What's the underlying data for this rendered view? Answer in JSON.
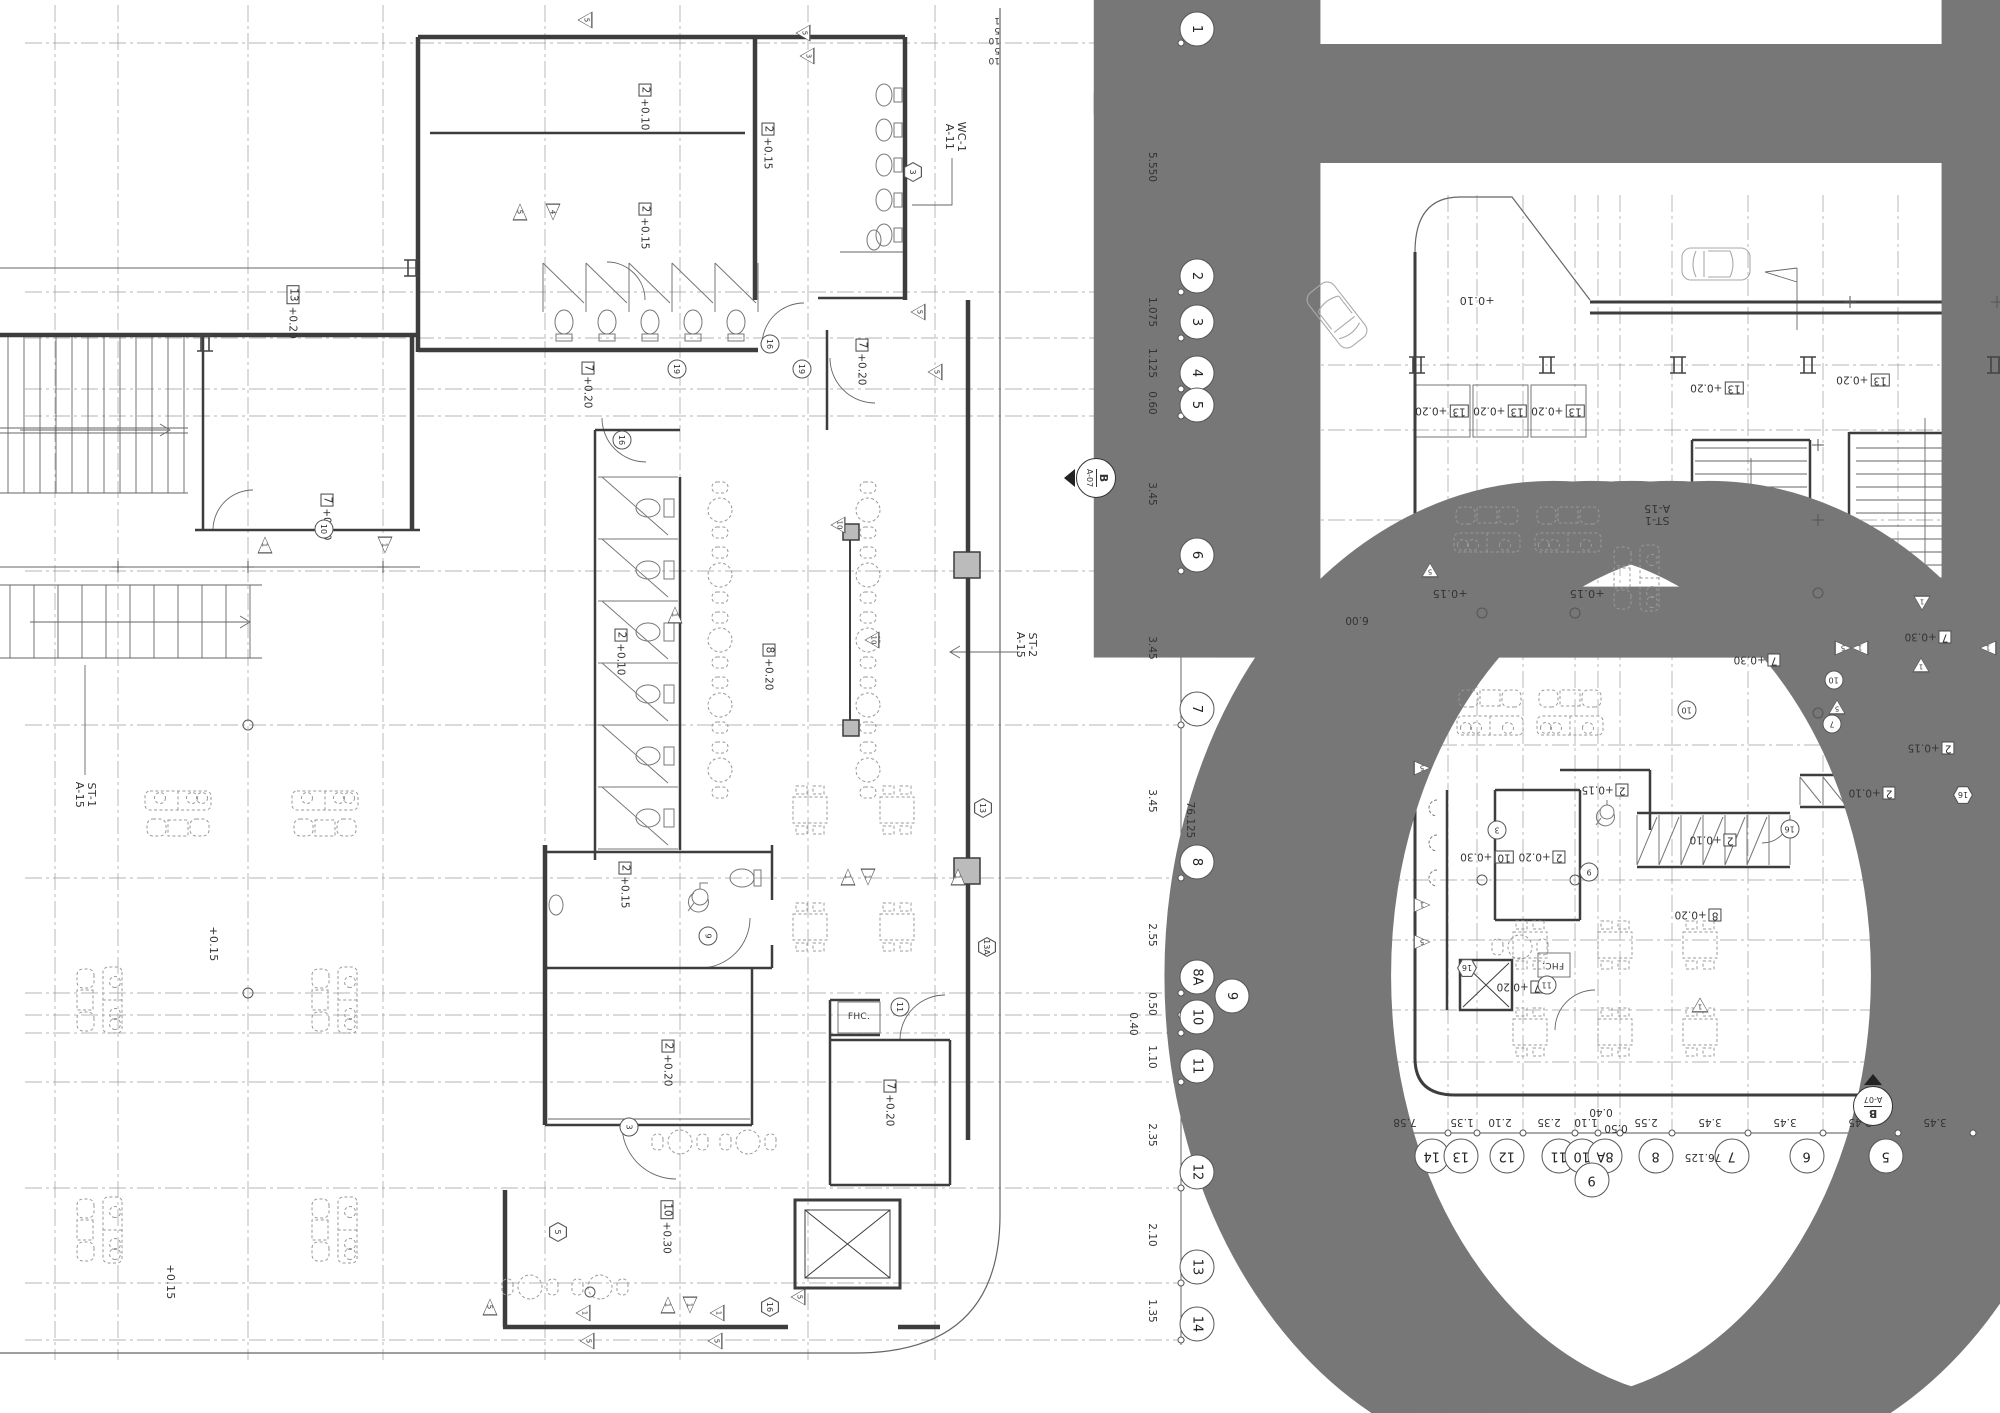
{
  "drawing": {
    "left_axis": {
      "bubbles": [
        "1",
        "2",
        "3",
        "4",
        "5",
        "6",
        "7",
        "8",
        "8A",
        "10",
        "9",
        "11",
        "12",
        "13",
        "14"
      ],
      "dims": [
        "5.550",
        "1.075",
        "1.125",
        "0.60",
        "3.45",
        "3.45",
        "3.45",
        "76.125",
        "2.55",
        "0.50",
        "0.40",
        "1.10",
        "2.35",
        "2.10",
        "1.35"
      ]
    },
    "bottom_axis": {
      "bubbles": [
        "14",
        "13",
        "12",
        "11",
        "10",
        "8A",
        "9",
        "8",
        "7",
        "6",
        "5"
      ],
      "dims": [
        "7.58",
        "1.35",
        "2.10",
        "2.35",
        "1.10",
        "0.40",
        "0.50",
        "2.55",
        "3.45",
        "76.125",
        "3.45",
        "3.45",
        "3.45"
      ]
    },
    "left_plan": {
      "tags": [
        {
          "n": "13",
          "e": "+0.20"
        },
        {
          "n": "7",
          "e": "+0.30"
        },
        {
          "n": "2",
          "e": "+0.10"
        },
        {
          "n": "2",
          "e": "+0.15"
        },
        {
          "n": "2",
          "e": "+0.15"
        },
        {
          "n": "7",
          "e": "+0.20"
        },
        {
          "n": "7",
          "e": "+0.20"
        },
        {
          "n": "2",
          "e": "+0.10"
        },
        {
          "n": "8",
          "e": "+0.20"
        },
        {
          "n": "2",
          "e": "+0.15"
        },
        {
          "n": "2",
          "e": "+0.20"
        },
        {
          "n": "10",
          "e": "+0.30"
        },
        {
          "n": "7",
          "e": "+0.20"
        }
      ],
      "levels": [
        "+0.15",
        "+0.15"
      ],
      "wc_note": "WC-1\nA-11",
      "st1_note": "ST-1\nA-15",
      "st2_note": "ST-2\nA-15",
      "fhc": "FHC.",
      "section": {
        "id": "B",
        "sheet": "A-07"
      },
      "stair_risers": [
        "5",
        "10"
      ],
      "door_circles": [
        "16",
        "19",
        "19",
        "16",
        "9",
        "11",
        "3",
        "10"
      ],
      "hex_tags": [
        "3",
        "13",
        "13A",
        "5",
        "16"
      ],
      "tri_tags": [
        "5",
        "5",
        "3",
        "5",
        "4",
        "1",
        "1",
        "5",
        "5",
        "10",
        "10",
        "1",
        "1",
        "1",
        "1",
        "1",
        "5",
        "1",
        "1",
        "1",
        "5",
        "5",
        "5"
      ]
    },
    "right_plan": {
      "tags": [
        {
          "n": "13",
          "e": "+0.20"
        },
        {
          "n": "13",
          "e": "+0.20"
        },
        {
          "n": "13",
          "e": "+0.20"
        },
        {
          "n": "13",
          "e": "+0.20"
        },
        {
          "n": "13",
          "e": "+0.20"
        },
        {
          "n": "7",
          "e": "+0.30"
        },
        {
          "n": "7",
          "e": "+0.30"
        },
        {
          "n": "2",
          "e": "+0.15"
        },
        {
          "n": "2",
          "e": "+0.15"
        },
        {
          "n": "2",
          "e": "+0.10"
        },
        {
          "n": "2",
          "e": "+0.10"
        },
        {
          "n": "2",
          "e": "+0.20"
        },
        {
          "n": "10",
          "e": "+0.30"
        },
        {
          "n": "8",
          "e": "+0.20"
        },
        {
          "n": "7",
          "e": "+0.20"
        }
      ],
      "levels": [
        "+0.10",
        "+0.15",
        "+0.15"
      ],
      "st1_note": "ST-1\nA-15",
      "fhc": "FHC.",
      "dim": "6.00",
      "section": {
        "id": "B",
        "sheet": "A-07"
      },
      "stair_risers": [
        "1",
        "5",
        "10",
        "5",
        "10"
      ],
      "door_circles": [
        "9",
        "11",
        "3",
        "10",
        "7",
        "16",
        "10"
      ],
      "hex_tags": [
        "16",
        "16"
      ],
      "tri_tags": [
        "1",
        "1",
        "5",
        "1",
        "1",
        "5",
        "5",
        "1",
        "5",
        "1",
        "5"
      ]
    }
  }
}
